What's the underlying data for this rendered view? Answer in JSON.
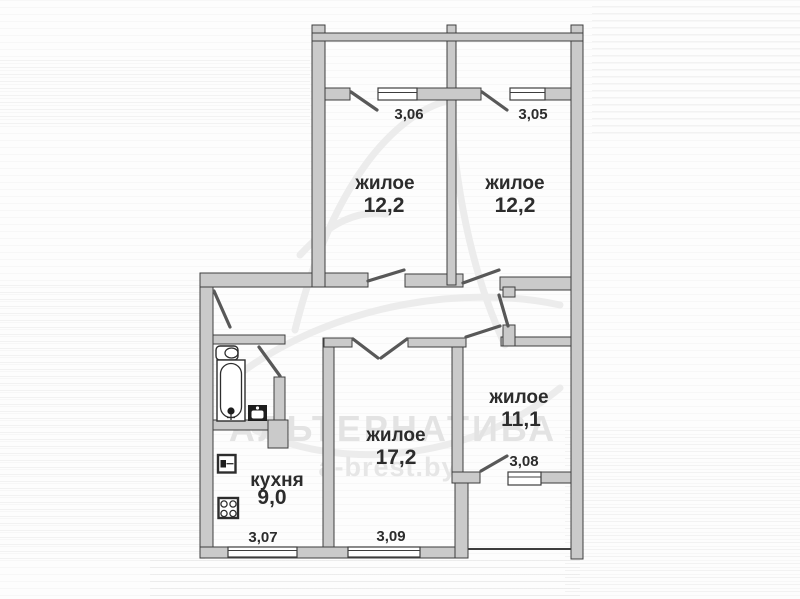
{
  "plan": {
    "rooms": [
      {
        "id": "bedroom-1",
        "name": "жилое",
        "area": "12,2",
        "width_label": "3,06"
      },
      {
        "id": "bedroom-2",
        "name": "жилое",
        "area": "12,2",
        "width_label": "3,05"
      },
      {
        "id": "bedroom-3",
        "name": "жилое",
        "area": "11,1",
        "width_label": "3,08"
      },
      {
        "id": "living-room",
        "name": "жилое",
        "area": "17,2",
        "width_label": "3,09"
      },
      {
        "id": "kitchen",
        "name": "кухня",
        "area": "9,0",
        "width_label": "3,07"
      }
    ],
    "watermark": {
      "brand": "АЛЬТЕРНАТИВА",
      "site": "a-brest.by"
    },
    "colors": {
      "wall_fill": "#cacaca",
      "wall_stroke": "#3e3e3e",
      "label": "#2c2c2c",
      "watermark": "#e3e3e3"
    }
  }
}
